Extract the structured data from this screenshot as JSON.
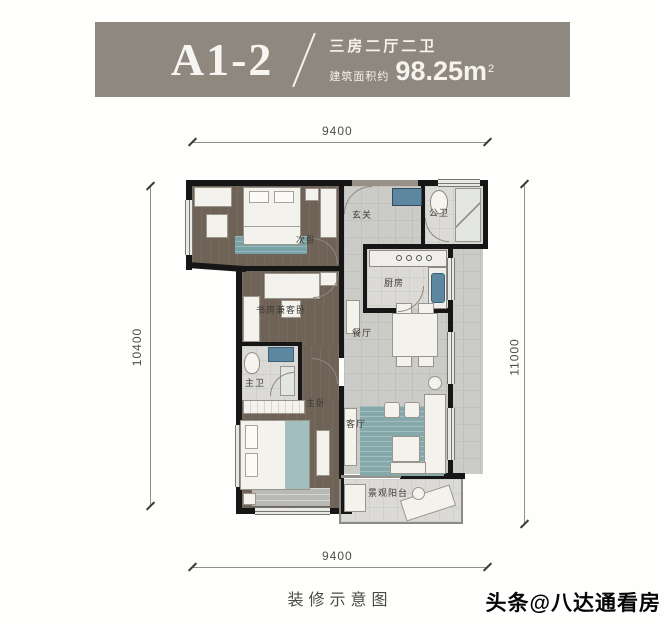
{
  "header": {
    "unit_code": "A1-2",
    "layout_type": "三房二厅二卫",
    "area_prefix": "建筑面积约",
    "area_number": "98.25m",
    "area_sup": "2"
  },
  "dimensions": {
    "top": "9400",
    "bottom": "9400",
    "left": "10400",
    "right": "11000"
  },
  "rooms": [
    {
      "name": "secondary-bedroom",
      "label": "次卧"
    },
    {
      "name": "entry-hall",
      "label": "玄关"
    },
    {
      "name": "public-bathroom",
      "label": "公卫"
    },
    {
      "name": "kitchen",
      "label": "厨房"
    },
    {
      "name": "study-guest-bedroom",
      "label": "书房兼客卧"
    },
    {
      "name": "master-bathroom",
      "label": "主卫"
    },
    {
      "name": "dining-room",
      "label": "餐厅"
    },
    {
      "name": "master-bedroom",
      "label": "主卧"
    },
    {
      "name": "living-room",
      "label": "客厅"
    },
    {
      "name": "view-balcony",
      "label": "景观阳台"
    }
  ],
  "footer": {
    "caption": "装修示意图",
    "watermark": "头条@八达通看房"
  },
  "colors": {
    "banner": "#8f887e",
    "wall": "#161616",
    "dark_floor": "#6e6356",
    "light_floor": "#cbcbc7",
    "rug": "#79a2a6"
  }
}
